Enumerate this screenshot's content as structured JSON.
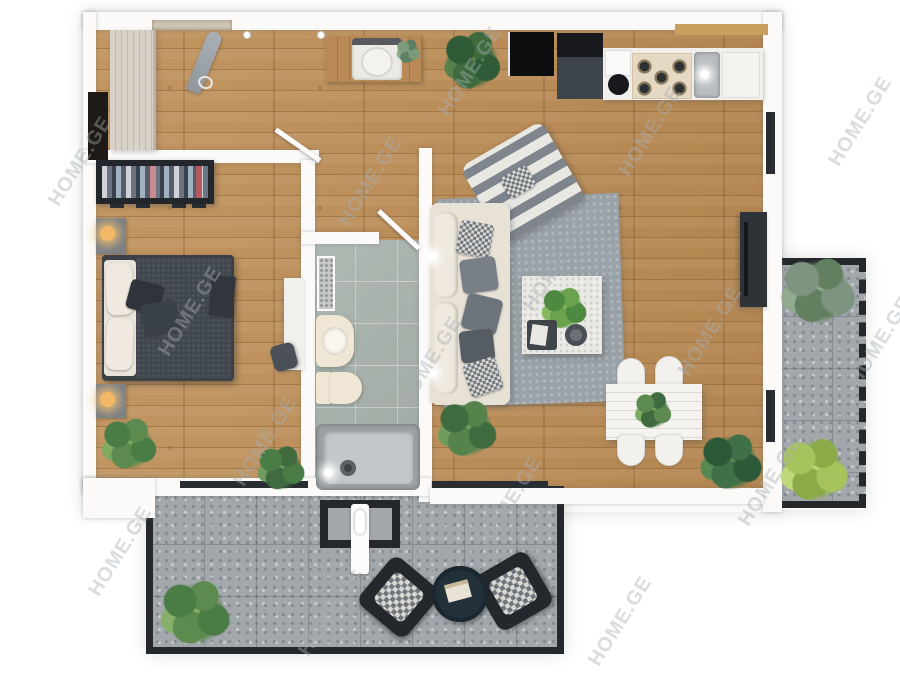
{
  "watermark": {
    "text": "HOME.GE"
  },
  "palette": {
    "background": "#ffffff",
    "wall_white": "#fbfaf8",
    "wood_floor": "#bd8d55",
    "wood_plank_line": "#72502a",
    "bathroom_tile": "#a9b2ac",
    "paver_gray": "#a2a7ab",
    "frame_dark": "#24282c",
    "bed_charcoal": "#3c4148",
    "duvet_dark": "#41474f",
    "mattress_cream": "#efe9df",
    "sofa_cream": "#e8e2d6",
    "rug_gray": "#99a2a8",
    "pillow_gray": "#787f87",
    "blanket_stripe_gray": "#7e858d",
    "counter_white": "#f0efec",
    "stove_beige": "#e6d9c4",
    "appliance_dark": "#3e444b",
    "fridge_top_black": "#17191c",
    "wardrobe_beige": "#d9d2c9",
    "clothes_rack_dark": "#23262b",
    "clothes_pink": "#c98a92",
    "clothes_red": "#b45a5e",
    "plant_dark_green": "#3f6b3f",
    "plant_mid_green": "#5d8a4e",
    "plant_light_green": "#a7c45c",
    "plant_sage": "#7d9480",
    "lamp_glow": "#f2b867",
    "terrace_table_teal": "#22303a",
    "watermark_gray": "#a8adb2"
  }
}
